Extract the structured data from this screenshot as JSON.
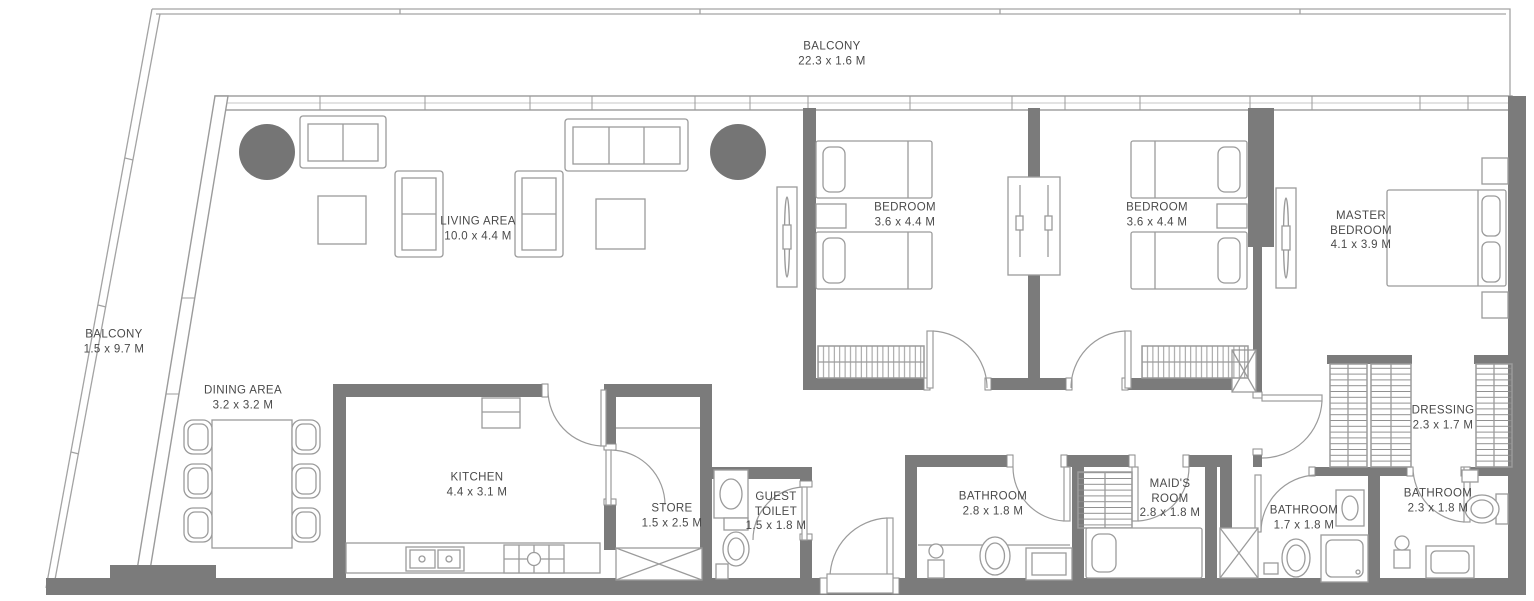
{
  "plan": {
    "title": "Apartment floor plan",
    "colors": {
      "wall": "#7b7b7b",
      "line": "#9b9b9b",
      "dark_fill": "#757575",
      "text": "#4a4a4a",
      "background": "#ffffff"
    },
    "rooms": [
      {
        "id": "balcony-top",
        "label": "BALCONY",
        "dims": "22.3 x 1.6 M"
      },
      {
        "id": "balcony-left",
        "label": "BALCONY",
        "dims": "1.5 x 9.7 M"
      },
      {
        "id": "living-area",
        "label": "LIVING AREA",
        "dims": "10.0 x 4.4 M"
      },
      {
        "id": "dining-area",
        "label": "DINING AREA",
        "dims": "3.2 x 3.2 M"
      },
      {
        "id": "kitchen",
        "label": "KITCHEN",
        "dims": "4.4 x 3.1 M"
      },
      {
        "id": "store",
        "label": "STORE",
        "dims": "1.5 x 2.5 M"
      },
      {
        "id": "guest-toilet",
        "label": "GUEST TOILET",
        "dims": "1.5 x 1.8 M"
      },
      {
        "id": "bedroom-1",
        "label": "BEDROOM",
        "dims": "3.6 x 4.4 M"
      },
      {
        "id": "bedroom-2",
        "label": "BEDROOM",
        "dims": "3.6 x 4.4 M"
      },
      {
        "id": "master-bedroom",
        "label": "MASTER BEDROOM",
        "dims": "4.1 x 3.9 M"
      },
      {
        "id": "dressing",
        "label": "DRESSING",
        "dims": "2.3 x 1.7 M"
      },
      {
        "id": "bathroom-1",
        "label": "BATHROOM",
        "dims": "2.8 x 1.8 M"
      },
      {
        "id": "maids-room",
        "label": "MAID'S ROOM",
        "dims": "2.8 x 1.8 M"
      },
      {
        "id": "bathroom-2",
        "label": "BATHROOM",
        "dims": "1.7 x 1.8 M"
      },
      {
        "id": "bathroom-3",
        "label": "BATHROOM",
        "dims": "2.3 x 1.8 M"
      }
    ]
  }
}
